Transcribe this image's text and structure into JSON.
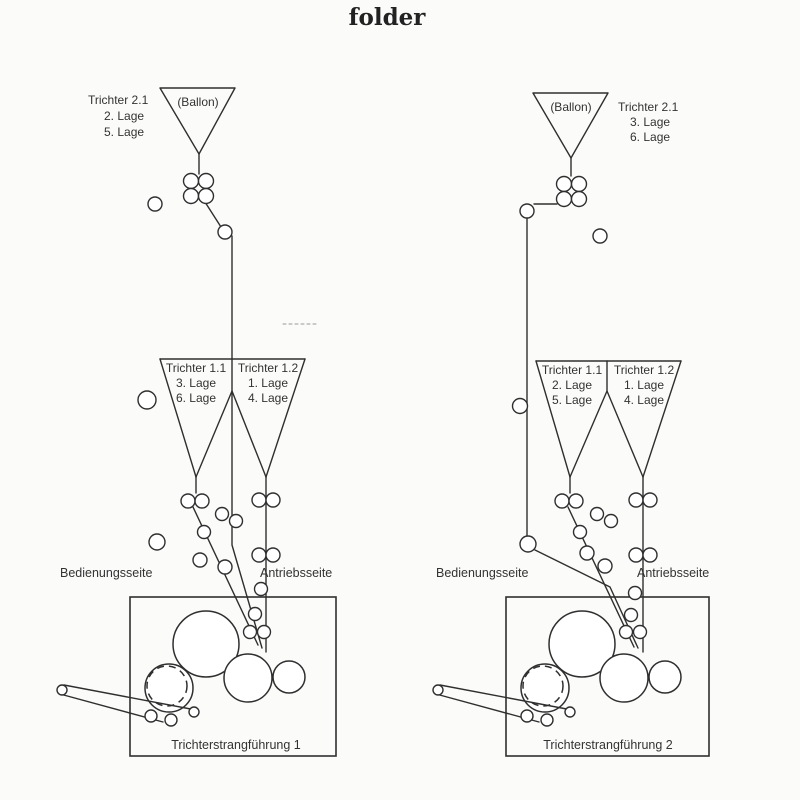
{
  "title": "folder",
  "colors": {
    "line": "#2f2f2f",
    "text": "#333333",
    "background": "#fbfbf9"
  },
  "diagram1": {
    "funnel21": {
      "label": "(Ballon)",
      "title": "Trichter 2.1",
      "lage_a": "2. Lage",
      "lage_b": "5. Lage"
    },
    "funnel11": {
      "title": "Trichter 1.1",
      "lage_a": "3. Lage",
      "lage_b": "6. Lage"
    },
    "funnel12": {
      "title": "Trichter 1.2",
      "lage_a": "1. Lage",
      "lage_b": "4. Lage"
    },
    "operator_side": "Bedienungsseite",
    "drive_side": "Antriebsseite",
    "box_label": "Trichterstrangführung 1"
  },
  "diagram2": {
    "funnel21": {
      "label": "(Ballon)",
      "title": "Trichter 2.1",
      "lage_a": "3. Lage",
      "lage_b": "6. Lage"
    },
    "funnel11": {
      "title": "Trichter 1.1",
      "lage_a": "2. Lage",
      "lage_b": "5. Lage"
    },
    "funnel12": {
      "title": "Trichter 1.2",
      "lage_a": "1. Lage",
      "lage_b": "4. Lage"
    },
    "operator_side": "Bedienungsseite",
    "drive_side": "Antriebsseite",
    "box_label": "Trichterstrangführung 2"
  }
}
